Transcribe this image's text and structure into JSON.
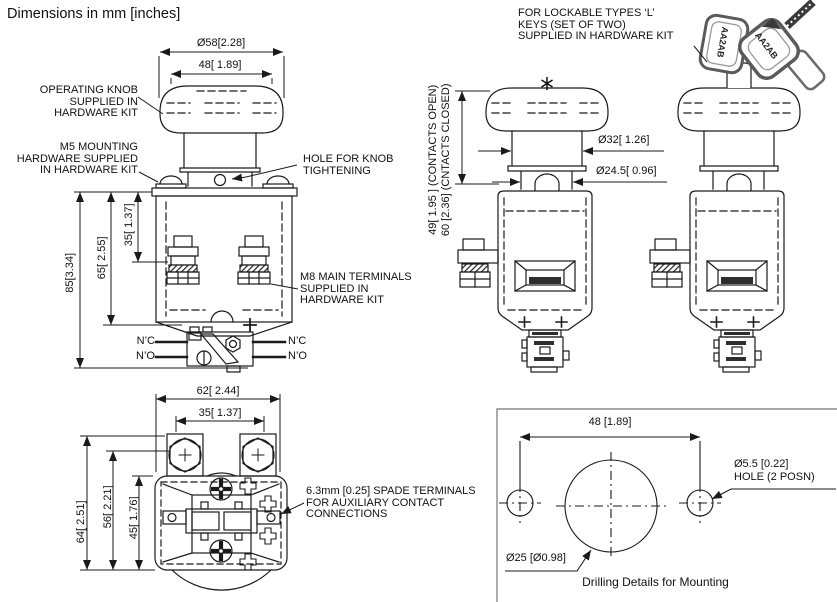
{
  "title": "Dimensions in mm [inches]",
  "front_view": {
    "labels": {
      "operating_knob": "OPERATING KNOB\nSUPPLIED IN\nHARDWARE KIT",
      "m5_mounting": "M5 MOUNTING\nHARDWARE SUPPLIED\nIN HARDWARE KIT",
      "hole_for_knob": "HOLE FOR KNOB\nTIGHTENING",
      "m8_terminals": "M8 MAIN TERMINALS\nSUPPLIED IN\nHARDWARE KIT"
    },
    "dims": {
      "knob_diameter": "Ø58[2.28]",
      "knob_top_width": "48[ 1.89]",
      "overall_height": "85[3.34]",
      "body_height": "65[ 2.55]",
      "terminal_height": "35[ 1.37]"
    },
    "aux_contacts": {
      "nc": "N’C",
      "no": "N’O"
    }
  },
  "side_view": {
    "dims": {
      "travel_open": "49[ 1.95 ] (CONTACTS OPEN)",
      "travel_closed": "60 [2.36] (CNTACTS CLOSED)",
      "stem_diameter": "Ø32[ 1.26]",
      "neck_diameter": "Ø24.5[ 0.96]"
    }
  },
  "lockable_view": {
    "label": "FOR LOCKABLE TYPES ‘L’\nKEYS (SET OF TWO)\nSUPPLIED IN HARDWARE KIT",
    "key_text": "AA2AB"
  },
  "bottom_view": {
    "label_spade_terminals": "6.3mm [0.25] SPADE TERMINALS\nFOR AUXILIARY CONTACT\nCONNECTIONS",
    "dims": {
      "base_width": "62[ 2.44]",
      "terminal_pitch": "35[ 1.37]",
      "overall_depth": "64[ 2.51]",
      "inner_depth": "56[ 2.21]",
      "body_depth": "45[ 1.76]"
    }
  },
  "drilling_details": {
    "hole_pitch": "48 [1.89]",
    "mount_hole_dia": "Ø5.5 [0.22]",
    "mount_hole_note": "HOLE (2 POSN)",
    "center_hole_dia": "Ø25 [Ø0.98]",
    "caption": "Drilling Details for Mounting"
  }
}
